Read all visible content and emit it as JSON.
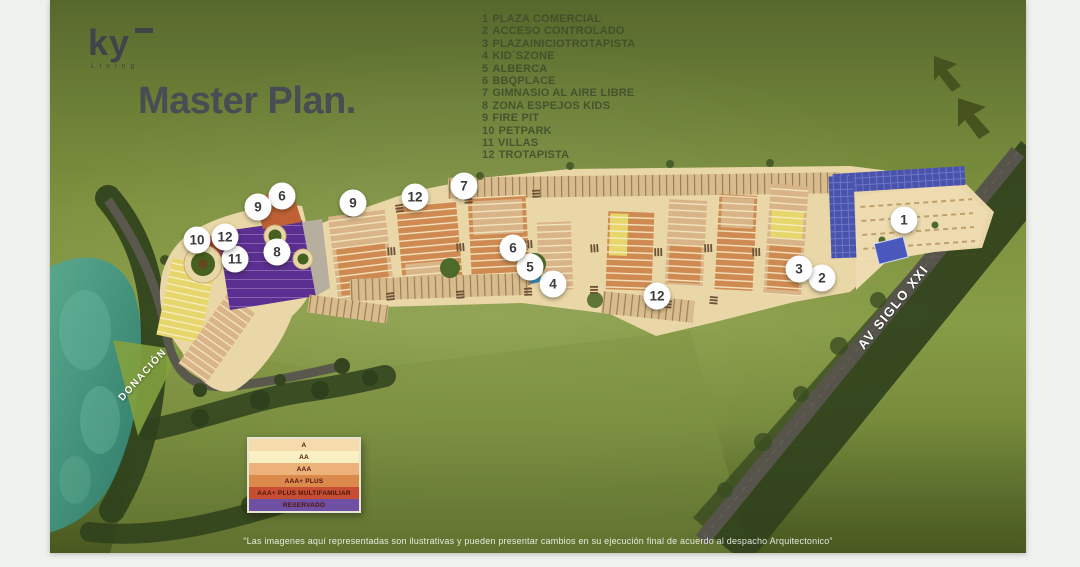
{
  "page": {
    "title": "Master Plan.",
    "disclaimer": "“Las imagenes aquí representadas son ilustrativas y pueden presentar cambios en su ejecución final de acuerdo al despacho Arquitectonico”"
  },
  "brand": {
    "logo_text": "ky",
    "logo_subtext": "Living"
  },
  "amenities_legend": {
    "items": [
      {
        "num": "1",
        "label": "PLAZA COMERCIAL"
      },
      {
        "num": "2",
        "label": "ACCESO CONTROLADO"
      },
      {
        "num": "3",
        "label": "PLAZAINICIOTROTAPISTA"
      },
      {
        "num": "4",
        "label": "KID´SZONE"
      },
      {
        "num": "5",
        "label": "ALBERCA"
      },
      {
        "num": "6",
        "label": "BBQPLACE"
      },
      {
        "num": "7",
        "label": "GIMNASIO AL AIRE LIBRE"
      },
      {
        "num": "8",
        "label": "ZONA ESPEJOS KIDS"
      },
      {
        "num": "9",
        "label": "FIRE PIT"
      },
      {
        "num": "10",
        "label": "PETPARK"
      },
      {
        "num": "11",
        "label": "VILLAS"
      },
      {
        "num": "12",
        "label": "TROTAPISTA"
      }
    ]
  },
  "map": {
    "markers": [
      {
        "label": "1",
        "x": 854,
        "y": 220
      },
      {
        "label": "2",
        "x": 772,
        "y": 278
      },
      {
        "label": "3",
        "x": 749,
        "y": 269
      },
      {
        "label": "4",
        "x": 503,
        "y": 284
      },
      {
        "label": "5",
        "x": 480,
        "y": 267
      },
      {
        "label": "6",
        "x": 463,
        "y": 248
      },
      {
        "label": "6",
        "x": 232,
        "y": 196
      },
      {
        "label": "7",
        "x": 414,
        "y": 186
      },
      {
        "label": "8",
        "x": 227,
        "y": 252
      },
      {
        "label": "9",
        "x": 208,
        "y": 207
      },
      {
        "label": "9",
        "x": 303,
        "y": 203
      },
      {
        "label": "10",
        "x": 147,
        "y": 240
      },
      {
        "label": "11",
        "x": 185,
        "y": 259
      },
      {
        "label": "12",
        "x": 175,
        "y": 237
      },
      {
        "label": "12",
        "x": 365,
        "y": 197
      },
      {
        "label": "12",
        "x": 607,
        "y": 296
      }
    ],
    "road_labels": [
      {
        "text": "DONACIÓN",
        "x": 93,
        "y": 375,
        "angle": -48,
        "size": 10
      },
      {
        "text": "AV SIGLO XXI",
        "x": 843,
        "y": 307,
        "angle": -51,
        "size": 13
      }
    ]
  },
  "category_legend": {
    "rows": [
      {
        "label": "A",
        "color": "#F6DCAC"
      },
      {
        "label": "AA",
        "color": "#F8EFC2"
      },
      {
        "label": "AAA",
        "color": "#ECB27A"
      },
      {
        "label": "AAA+ PLUS",
        "color": "#DB8A4C"
      },
      {
        "label": "AAA+ PLUS MULTIFAMILIAR",
        "color": "#C74E33"
      },
      {
        "label": "RESERVADO",
        "color": "#7050A2"
      }
    ]
  },
  "palette": {
    "page_background": "#EFF1EE",
    "canvas_green_top": "#57682D",
    "canvas_green_mid": "#879C46",
    "canvas_green_bottom": "#48581F",
    "title_text": "#474D53",
    "amenities_text": "#3D4A2B",
    "marker_background": "#FEFEFE",
    "marker_text": "#3B3B3B",
    "road_label_text": "#FFFFFF",
    "villas_block": "#5B2E91",
    "reserved_block": "#AC3A2B",
    "solar_panels": "#4A53AB",
    "lake_water": "#4A9A85"
  }
}
